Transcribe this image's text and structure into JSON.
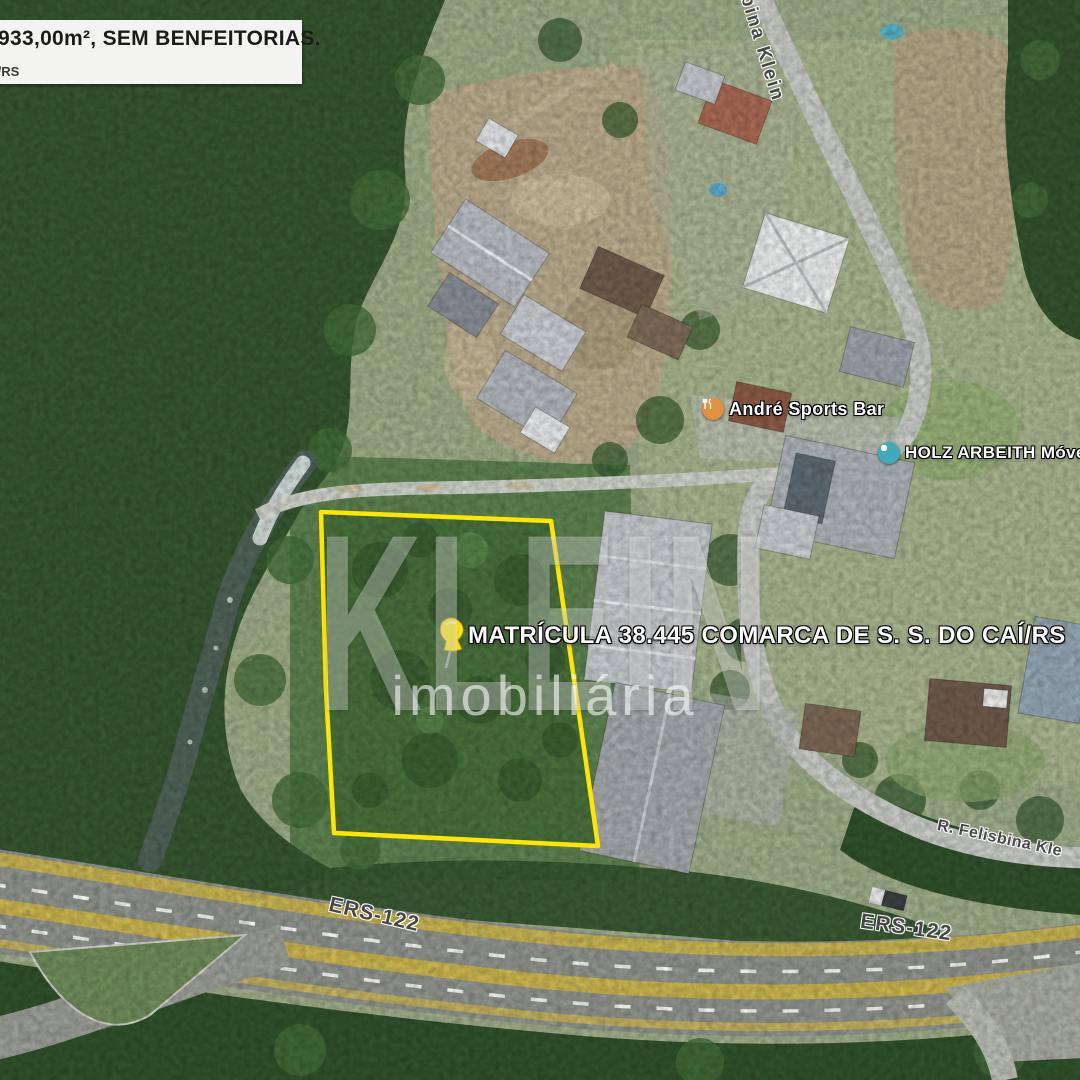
{
  "info_box": {
    "line1": "933,00m², SEM BENFEITORIAS.",
    "line2": "Í/RS"
  },
  "watermark": {
    "line1": "KLEIN",
    "line2": "imobiliária"
  },
  "annotation": {
    "matricula": "MATRÍCULA 38.445 COMARCA DE S. S. DO CAÍ/RS"
  },
  "pois": [
    {
      "name": "André Sports Bar",
      "icon": "restaurant-icon",
      "color": "#e0903f"
    },
    {
      "name": "HOLZ ARBEITH Móveis",
      "icon": "store-icon",
      "color": "#3fa9bd"
    }
  ],
  "streets": {
    "vertical_street": "bina Klein",
    "street_bottom_right": "R. Felisbina Kle",
    "highway_left": "ERS-122",
    "highway_right": "ERS-122"
  },
  "colors": {
    "property_boundary": "#ffe600",
    "pin": "#fce51c",
    "highway_stripe": "#c9b44e",
    "forest": "#35552f",
    "field": "#486f3b"
  }
}
